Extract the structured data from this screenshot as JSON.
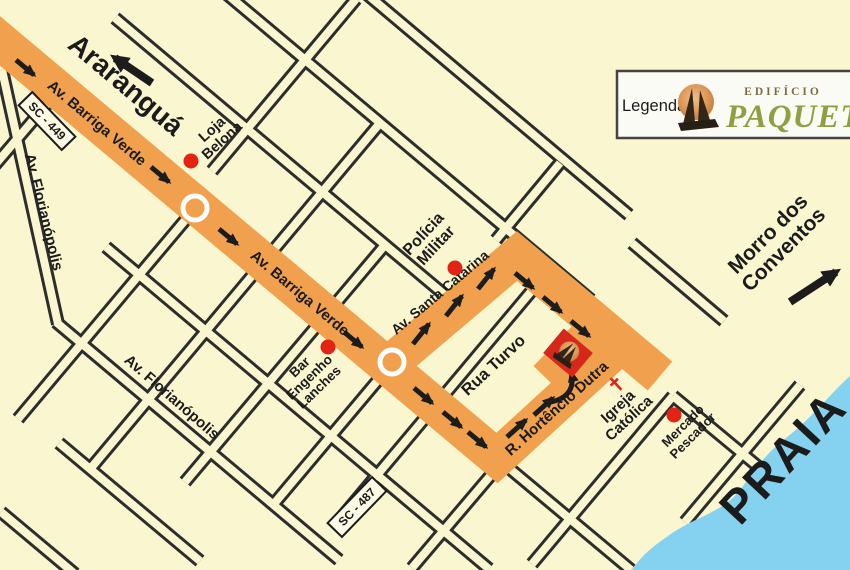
{
  "map": {
    "destinations": {
      "araranguá": "Araranguá",
      "morro": [
        "Morro dos",
        "Conventos"
      ],
      "praia": "PRAIA"
    },
    "roads": {
      "barriga_verde": "Av. Barriga Verde",
      "florianopolis": "Av. Florianópolis",
      "santa_catarina": "Av. Santa Catarina",
      "rua_turvo": "Rua Turvo",
      "hortencio_dutra": "R. Hortêncio Dutra",
      "sc449": "SC - 449",
      "sc487": "SC - 487"
    },
    "places": {
      "loja": [
        "Loja",
        "Belona"
      ],
      "policia": [
        "Polícia",
        "Militar"
      ],
      "bar": [
        "Bar",
        "Engenho",
        "Lanches"
      ],
      "igreja": [
        "Igreja",
        "Católica"
      ],
      "mercado": [
        "Mercado",
        "Pescador"
      ]
    },
    "colors": {
      "background_cream": "#FAF6D0",
      "route_orange": "#F1A14D",
      "street_black": "#2D2D2D",
      "water_blue": "#85D2F0",
      "poi_red": "#E32313",
      "marker_red": "#D6281A",
      "brand_olive": "#8FA040"
    }
  },
  "legend": {
    "label": "Legenda:",
    "building_type": "EDIFÍCIO",
    "building_name": "PAQUETÁ"
  }
}
